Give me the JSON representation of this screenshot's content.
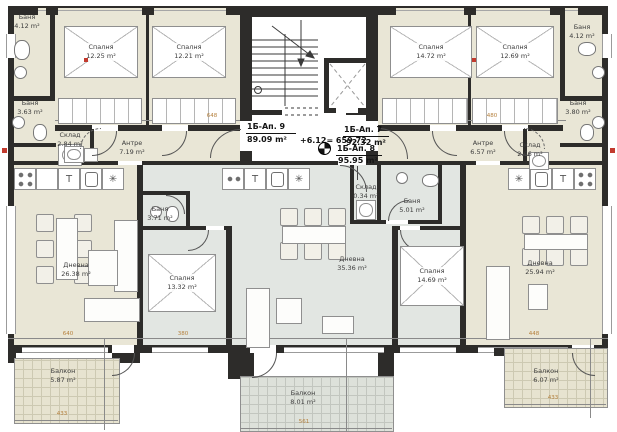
{
  "title": "Typical floor plan — three apartments",
  "header": {
    "apt9": {
      "label": "1Б-Ап. 9",
      "area": "89.09 m²"
    },
    "apt7": {
      "label": "1Б-Ап. 7",
      "area": "92.32 m²"
    },
    "apt8": {
      "label": "1Б-Ап. 8",
      "area": "95.95 m²"
    },
    "elevation": "+6.12= 659.72"
  },
  "rooms": [
    {
      "name": "Баня",
      "area": "4.12 m²"
    },
    {
      "name": "Спалня",
      "area": "12.25 m²"
    },
    {
      "name": "Спалня",
      "area": "12.21 m²"
    },
    {
      "name": "Баня",
      "area": "3.63 m²"
    },
    {
      "name": "Склад",
      "area": "2.84 m²"
    },
    {
      "name": "Антре",
      "area": "7.19 m²"
    },
    {
      "name": "Дневна",
      "area": "26.38 m²"
    },
    {
      "name": "Балкон",
      "area": "5.87 m²"
    },
    {
      "name": "Спалня",
      "area": "13.32 m²"
    },
    {
      "name": "Баня",
      "area": "3.71 m²"
    },
    {
      "name": "Дневна",
      "area": "35.36 m²"
    },
    {
      "name": "Баня",
      "area": "5.01 m²"
    },
    {
      "name": "Склад",
      "area": "0.34 m²"
    },
    {
      "name": "Спалня",
      "area": "14.69 m²"
    },
    {
      "name": "Балкон",
      "area": "8.01 m²"
    },
    {
      "name": "Спалня",
      "area": "14.72 m²"
    },
    {
      "name": "Спалня",
      "area": "12.69 m²"
    },
    {
      "name": "Баня",
      "area": "4.12 m²"
    },
    {
      "name": "Баня",
      "area": "3.80 m²"
    },
    {
      "name": "Склад",
      "area": "2.66 m²"
    },
    {
      "name": "Антре",
      "area": "6.57 m²"
    },
    {
      "name": "Дневна",
      "area": "25.94 m²"
    },
    {
      "name": "Балкон",
      "area": "6.07 m²"
    }
  ],
  "dims": {
    "hall_left": "648",
    "hall_right": "480",
    "left_width": "640",
    "mid_width": "380",
    "right_width": "448",
    "balc_left": "433",
    "balc_mid": "561",
    "balc_right": "433"
  },
  "icons": {
    "freezer": "✳",
    "tap": "T"
  },
  "colors": {
    "wall": "#2d2c2a",
    "room_beige": "#e9e6d6",
    "room_gray": "#e2e6e2",
    "tile_beige": "#e7e3d0",
    "tile_gray": "#dde1da",
    "dim_text": "#b5803d",
    "section_mark": "#c23a2e"
  }
}
